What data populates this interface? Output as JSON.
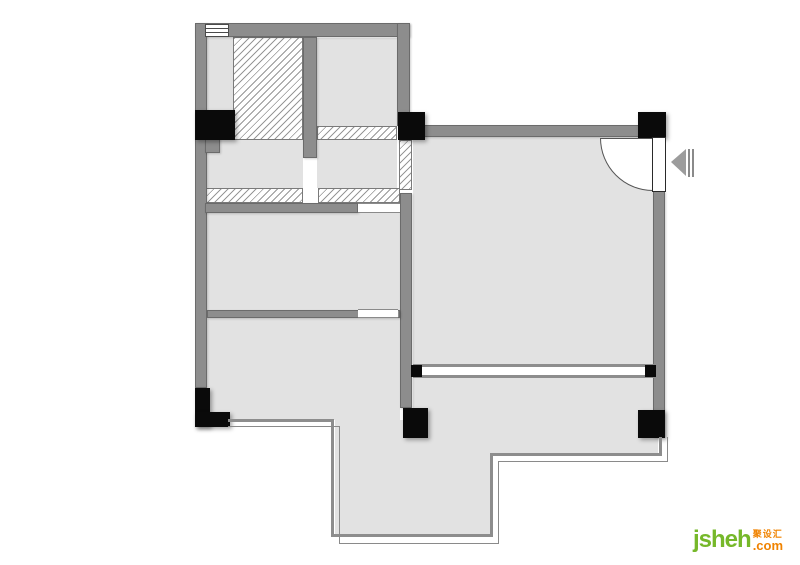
{
  "logo": {
    "name": "jsheh",
    "domain_suffix": ".com",
    "cn": "聚设汇",
    "green": "#76b82a",
    "orange": "#f08300"
  },
  "palette": {
    "background": "#ffffff",
    "wall": "#8d8d8d",
    "wall_edge": "#6b6b6b",
    "floor": "#e2e2e2",
    "column": "#0a0a0a",
    "hatch_line": "#979797",
    "thin_outline": "#8a8a8a",
    "arrow": "#9c9c9c"
  },
  "plan": {
    "type": "architectural-floor-plan",
    "visible_symbols": [
      "exterior-walls",
      "interior-walls",
      "hatched-wall-sections",
      "black-structural-columns",
      "entry-door-with-swing-arc",
      "entrance-direction-arrow",
      "window-symbols",
      "balcony-sliding-opening",
      "terrace-thin-outline"
    ]
  }
}
